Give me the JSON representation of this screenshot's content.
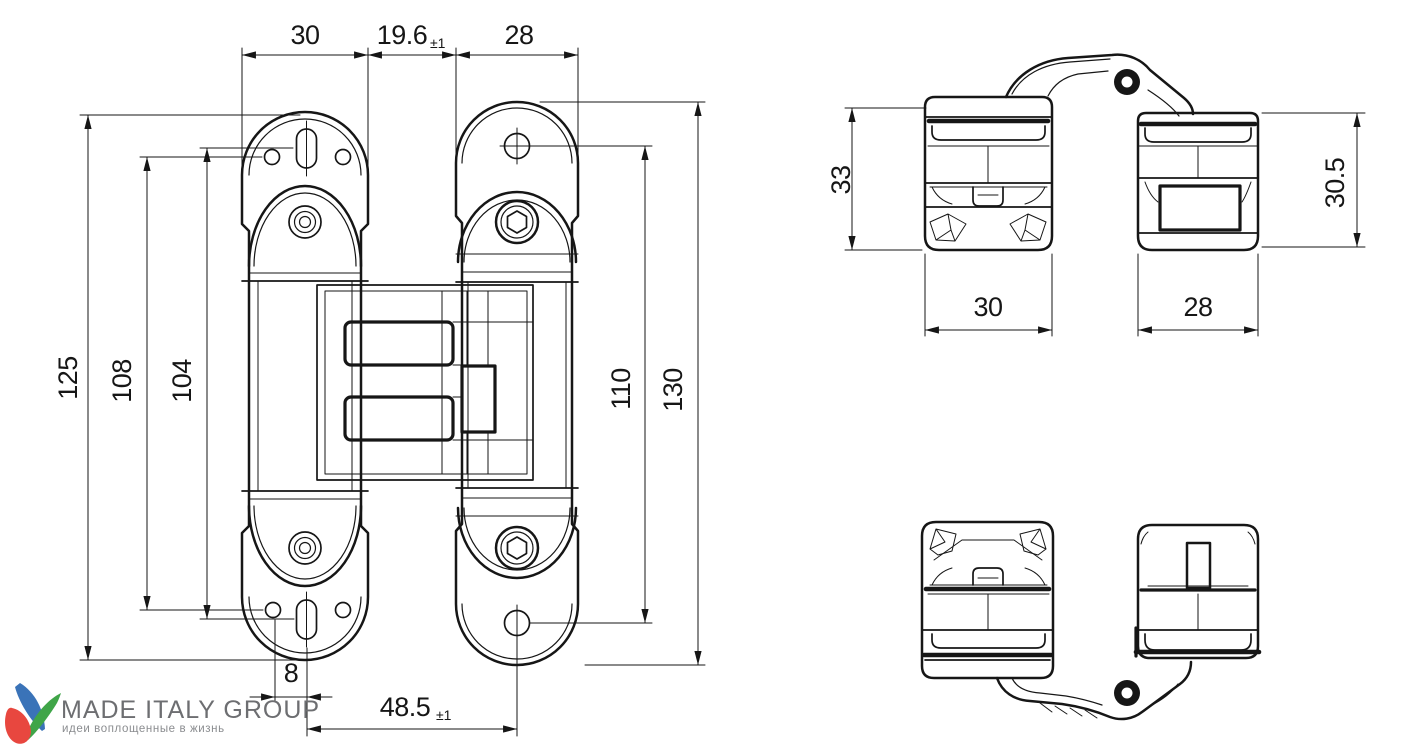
{
  "front_view": {
    "top": {
      "left_width": "30",
      "center_gap": "19.6",
      "center_gap_tol": "±1",
      "right_width": "28"
    },
    "left": {
      "total_height": "125",
      "hole_pitch": "108",
      "slot_pitch": "104"
    },
    "right": {
      "hole_pitch": "110",
      "total_height": "130"
    },
    "bottom": {
      "hole_offset": "8",
      "hole_span": "48.5",
      "hole_span_tol": "±1"
    }
  },
  "side_view": {
    "left_block_height": "33",
    "right_block_height": "30.5",
    "left_block_width": "30",
    "right_block_width": "28"
  },
  "logo": {
    "title": "MADE ITALY GROUP",
    "subtitle": "идеи воплощенные в жизнь",
    "colors": {
      "text": "#6d6e71",
      "blue": "#3a73b8",
      "red": "#e8473f",
      "green": "#3fa548"
    }
  },
  "drawing": {
    "line_color": "#161616",
    "background": "#ffffff"
  }
}
